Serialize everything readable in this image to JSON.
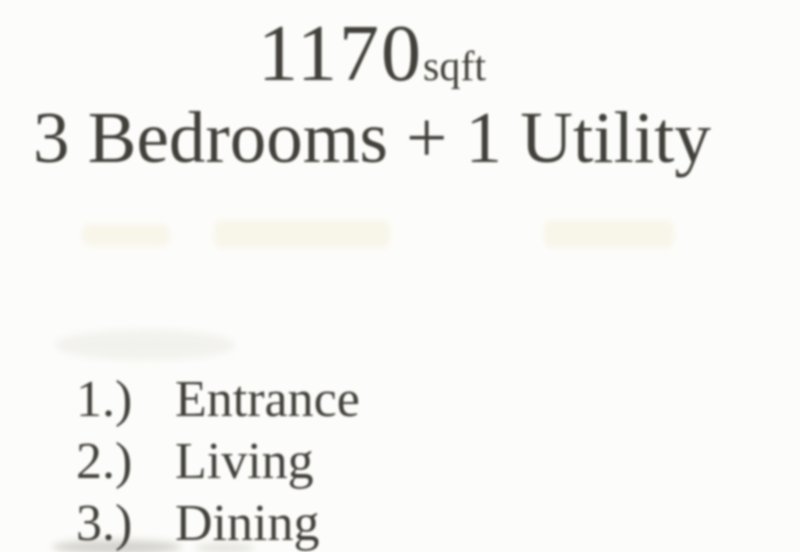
{
  "document": {
    "area": {
      "value": "1170",
      "unit": "sqft"
    },
    "title": "3 Bedrooms + 1 Utility",
    "legend": {
      "items": [
        {
          "number": "1.)",
          "label": "Entrance"
        },
        {
          "number": "2.)",
          "label": "Living"
        },
        {
          "number": "3.)",
          "label": "Dining"
        }
      ]
    },
    "colors": {
      "text": "#42403a",
      "background": "#fcfcfa",
      "artifact_band": "#f6f1df"
    }
  }
}
